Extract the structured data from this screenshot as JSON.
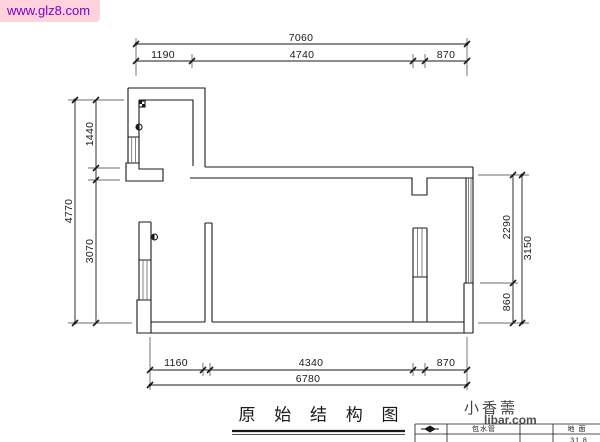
{
  "colors": {
    "line": "#1a1a1a",
    "hatch": "#666666",
    "wm_pink_bg": "#FFD2DC",
    "wm_purple": "#7A00C8",
    "wm_gray": "#2F2F2F"
  },
  "watermarks": {
    "top": {
      "text": "www.glz8.com"
    },
    "bottom": {
      "line1": "小香薷",
      "line2": "libar.com"
    }
  },
  "drawing_title": {
    "text": "原 始 结 构 图"
  },
  "dimensions": {
    "top": {
      "total": "7060",
      "segments": [
        "1190",
        "4740",
        "870"
      ]
    },
    "left": {
      "total": "4770",
      "segments": [
        "1440",
        "3070"
      ]
    },
    "right": {
      "total": "3150",
      "segments": [
        "2290",
        "860"
      ]
    },
    "bottom": {
      "total": "6780",
      "segments": [
        "1160",
        "4340",
        "870"
      ]
    }
  },
  "title_block": {
    "legend_label": "包水管",
    "floor_label": "地 面",
    "partial_value": "31.8"
  }
}
